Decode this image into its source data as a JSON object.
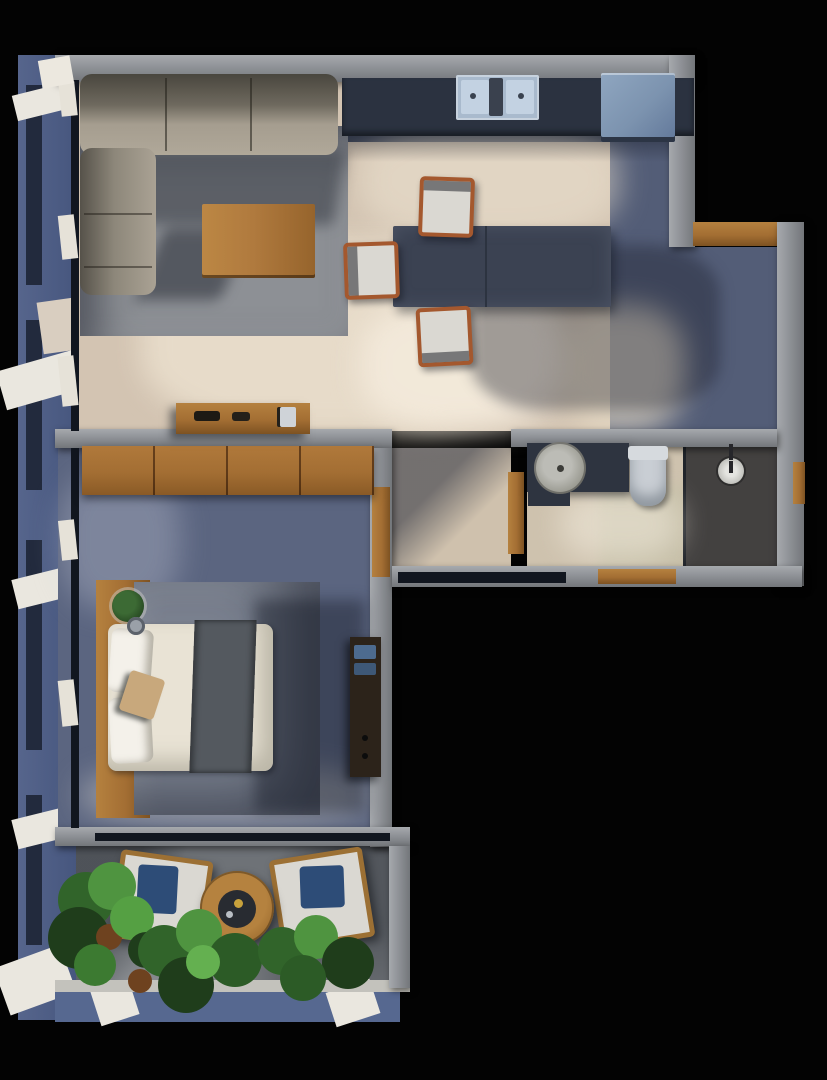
{
  "title": "Top-down 3D rendered apartment floor plan",
  "palette": {
    "bg": "#030303",
    "facade": "#4f6188",
    "facade-dark": "#1a2130",
    "fin-white": "#eae7df",
    "wall": "#8f9297",
    "wall-hi": "#a6a9ad",
    "wall-lo": "#73767a",
    "wood": "#a36e33",
    "wood-light": "#b5813f",
    "wood-dark": "#7d5222",
    "floor-beige": "#d3c4b2",
    "floor-beige-lit": "#f3e9d7",
    "floor-kitchen-dark": "#454d60",
    "floor-corridor": "#535d77",
    "rug-gray": "#8d9095",
    "rug-bed": "#7b8290",
    "floor-bed": "#5b6580",
    "floor-hall": "#cfc1ad",
    "bath-floor": "#cec2ae",
    "bath-floor-green": "#bdbaa0",
    "shower-floor": "#434140",
    "vanity-dark": "#2e3440",
    "toilet-white": "#c9ced4",
    "sink-round": "#98988f",
    "sofa": "#a59d8f",
    "sofa-shade": "#56524a",
    "coffee-wood": "#b07a3e",
    "table-dark": "#3b4252",
    "chair-wood": "#a4582e",
    "cushion-white": "#dad8d2",
    "counter-dark": "#2b3240",
    "sink-blue": "#a9bacd",
    "fridge-blue": "#7c93af",
    "mattress": "#e9e3d5",
    "pillow": "#f4f1ea",
    "runner-dark": "#54595f",
    "throw-tan": "#c8a87c",
    "dresser-dark": "#2c231a",
    "dresser-blue": "#4d6b8f",
    "balcony-floor": "#6e7277",
    "chair-wood-balc": "#9c7034",
    "pillow-blue": "#2d4c77",
    "plant-dark": "#1f3d1b",
    "plant-mid": "#31642a",
    "plant-light": "#4f9440",
    "pot-brown": "#6e421f",
    "glass-dark": "#11161f"
  },
  "scene": {
    "rooms": [
      {
        "label": "Living Room",
        "furniture": [
          "l-shaped-sofa",
          "coffee-table",
          "area-rug",
          "sideboard"
        ]
      },
      {
        "label": "Kitchen and Dining",
        "furniture": [
          "kitchen-counter",
          "double-sink",
          "refrigerator",
          "stone-dining-table",
          "dining-chair",
          "dining-chair",
          "dining-chair"
        ]
      },
      {
        "label": "Bathroom",
        "furniture": [
          "vanity-counter",
          "round-basin",
          "toilet",
          "walk-in-shower",
          "shower-head"
        ]
      },
      {
        "label": "Bedroom",
        "furniture": [
          "double-bed",
          "pillows",
          "bed-runner",
          "headboard-panel",
          "wardrobe",
          "nightstand-decor",
          "dresser",
          "area-rug"
        ]
      },
      {
        "label": "Balcony",
        "furniture": [
          "lounge-chair",
          "lounge-chair",
          "round-side-table",
          "potted-plants"
        ]
      },
      {
        "label": "Hallway",
        "furniture": []
      }
    ]
  }
}
